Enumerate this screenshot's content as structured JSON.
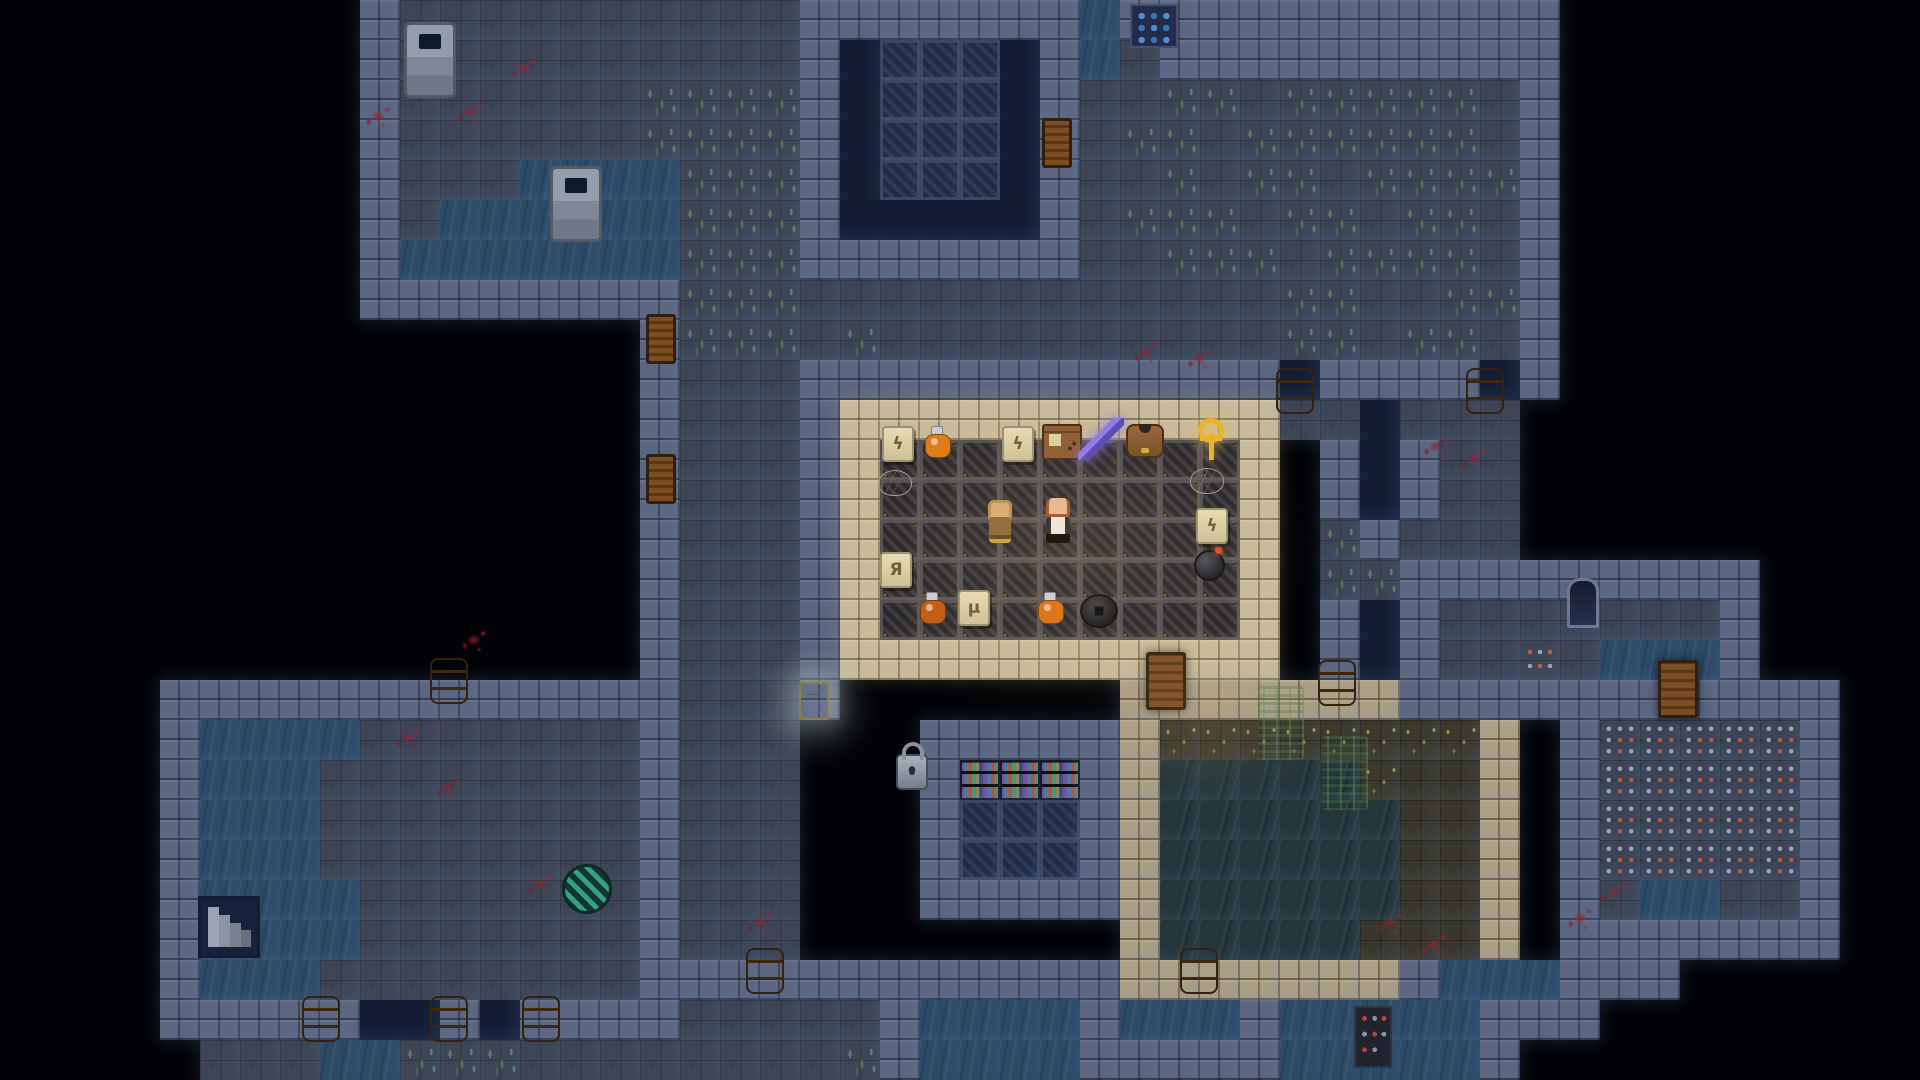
{
  "meta": {
    "game": "pixel-dungeon-roguelike",
    "scene": "sewer-depth-shop-level",
    "visible_text": [],
    "accent_colors": {
      "torch_warm": "#ffd28a",
      "glow_cool": "#7396cd",
      "blood": "#8e2030",
      "gold": "#e8b42a"
    }
  },
  "map": {
    "tile_size": 40,
    "cols": 48,
    "rows": 27,
    "legend": {
      "#": {
        "css": "tile-wall",
        "name": "wall",
        "interactable": false
      },
      ".": {
        "css": "tile-floor",
        "name": "floor",
        "interactable": true
      },
      ",": {
        "css": "tile-grass",
        "name": "floor-grass",
        "interactable": true
      },
      "~": {
        "css": "tile-water",
        "name": "water",
        "interactable": true
      },
      "o": {
        "css": "tile-void",
        "name": "chasm",
        "interactable": false
      },
      "L": {
        "css": "tile-lattice",
        "name": "vault-lattice",
        "interactable": false
      },
      "l": {
        "css": "tile-shoplattice",
        "name": "shop-floor",
        "interactable": true
      },
      "S": {
        "css": "tile-shopwall",
        "name": "shop-wall",
        "interactable": false
      },
      "C": {
        "css": "tile-cavewall",
        "name": "cave-wall",
        "interactable": false
      },
      "c": {
        "css": "tile-cave",
        "name": "cave-floor",
        "interactable": true
      },
      "g": {
        "css": "tile-cavegrass",
        "name": "cave-grass",
        "interactable": true
      },
      "v": {
        "css": "tile-cavewater",
        "name": "cave-water",
        "interactable": true
      },
      "T": {
        "css": "tile-trap",
        "name": "trap-plate",
        "interactable": true
      },
      "r": {
        "css": "tile-dots",
        "name": "ember-tile",
        "interactable": true
      },
      "k": {
        "css": "tile-bookshelf",
        "name": "bookshelf",
        "interactable": true
      }
    },
    "rows_data": [
      "         #..........#######~###########         ",
      "         #..........#oLLLo#~.##########         ",
      "         #......,,,,#oLLLo#..,,.,,,,,.#         ",
      "         #......,,,,#oLLLo#.,,.,,,,,,.#         ",
      "         #...~~~~,,,#oLLLo#..,.,,.,,,,#         ",
      "         #.~~~~~~,,,#ooooo#.,,,.,,.,,.#         ",
      "         #~~~~~~~,,,#######..,,,.,,,,.#         ",
      "         ########,,,............,,..,,#         ",
      "                #,,,.,..........,,.,,.#         ",
      "                #...############o####o#         ",
      "                #...#SSSSSSSSSSS..o...          ",
      "                #...#SlllllllllS #o#..          ",
      "                #...#SlllllllllS #o#..          ",
      "                #...#SlllllllllS ,#...          ",
      "                #...#SlllllllllS ,,#########    ",
      "                #...#SlllllllllS #o#.......#    ",
      "                #...#SSSSSSSSSSS #o#..r.~~~#    ",
      "    #############...#       CCCCCCC###########  ",
      "    #~~~~.......#...   #####CggggggggC #TTTTT#  ",
      "    #~~~........#...   #kkk#CvvvvvgccC #TTTTT#  ",
      "    #~~~........#...   #LLL#CvvvvvvccC #TTTTT#  ",
      "    #~~~........#...   #LLL#CvvvvvvccC #TTTTT#  ",
      "    #~~~~.......#...   #####CvvvvvvccC #.~~..#  ",
      "    #~~~~.......#...        CvvvvvcccC #######  ",
      "    #~~~........############CCCCCCC#~~~###      ",
      "    #####oo#o####.....#~~~~#~~~#~~~~~###        ",
      "     ...~~,,,........,#~~~~#####~~~~~#          "
    ]
  },
  "sprites": [
    {
      "kind": "well",
      "name": "well",
      "x": 404,
      "y": 22
    },
    {
      "kind": "well",
      "name": "well",
      "x": 550,
      "y": 166
    },
    {
      "kind": "window",
      "name": "wall-grate-window",
      "x": 1130,
      "y": 4,
      "interactable": false
    },
    {
      "kind": "door-s",
      "name": "vault-room-door",
      "x": 1042,
      "y": 118
    },
    {
      "kind": "door-s",
      "name": "corridor-door",
      "x": 646,
      "y": 314
    },
    {
      "kind": "door-s",
      "name": "corridor-door",
      "x": 646,
      "y": 454
    },
    {
      "kind": "door",
      "name": "shop-cave-door",
      "x": 1146,
      "y": 652
    },
    {
      "kind": "door",
      "name": "trap-room-door",
      "x": 1658,
      "y": 660
    },
    {
      "kind": "barrel",
      "name": "barrel",
      "x": 430,
      "y": 658
    },
    {
      "kind": "barrel",
      "name": "barrel",
      "x": 1276,
      "y": 368
    },
    {
      "kind": "barrel",
      "name": "barrel",
      "x": 1466,
      "y": 368
    },
    {
      "kind": "barrel",
      "name": "barrel",
      "x": 1318,
      "y": 660
    },
    {
      "kind": "barrel",
      "name": "barrel",
      "x": 1180,
      "y": 948
    },
    {
      "kind": "barrel",
      "name": "barrel",
      "x": 302,
      "y": 996
    },
    {
      "kind": "barrel",
      "name": "barrel",
      "x": 430,
      "y": 996
    },
    {
      "kind": "barrel",
      "name": "barrel",
      "x": 522,
      "y": 996
    },
    {
      "kind": "barrel",
      "name": "barrel",
      "x": 746,
      "y": 948
    },
    {
      "kind": "lock",
      "name": "vault-padlock",
      "x": 896,
      "y": 744
    },
    {
      "kind": "sign",
      "name": "glowing-sign",
      "x": 799,
      "y": 682,
      "interactable": false
    },
    {
      "kind": "niche",
      "name": "wall-alcove",
      "x": 1567,
      "y": 578,
      "interactable": false
    },
    {
      "kind": "stairs",
      "name": "sunken-stairs",
      "x": 198,
      "y": 896
    },
    {
      "kind": "disc",
      "name": "striped-trap-disc",
      "x": 562,
      "y": 864
    },
    {
      "kind": "redstrip",
      "name": "studded-plate",
      "x": 1354,
      "y": 1006,
      "interactable": false
    },
    {
      "kind": "vine",
      "name": "hanging-vines",
      "x": 1258,
      "y": 686,
      "interactable": false
    },
    {
      "kind": "vine",
      "name": "hanging-vines",
      "x": 1322,
      "y": 736,
      "interactable": false
    },
    {
      "kind": "blood",
      "name": "blood-splatter",
      "x": 360,
      "y": 100,
      "interactable": false
    },
    {
      "kind": "blood",
      "name": "blood-splatter",
      "x": 452,
      "y": 96,
      "interactable": false
    },
    {
      "kind": "blood",
      "name": "blood-splatter",
      "x": 506,
      "y": 52,
      "interactable": false
    },
    {
      "kind": "blood",
      "name": "blood-splatter",
      "x": 1128,
      "y": 336,
      "interactable": false
    },
    {
      "kind": "blood",
      "name": "blood-splatter",
      "x": 1182,
      "y": 342,
      "interactable": false
    },
    {
      "kind": "blood",
      "name": "blood-splatter",
      "x": 1418,
      "y": 430,
      "interactable": false
    },
    {
      "kind": "blood",
      "name": "blood-splatter",
      "x": 1456,
      "y": 442,
      "interactable": false
    },
    {
      "kind": "blood",
      "name": "blood-splatter",
      "x": 390,
      "y": 722,
      "interactable": false
    },
    {
      "kind": "blood",
      "name": "blood-splatter",
      "x": 430,
      "y": 772,
      "interactable": false
    },
    {
      "kind": "blood",
      "name": "blood-splatter",
      "x": 522,
      "y": 868,
      "interactable": false
    },
    {
      "kind": "blood",
      "name": "blood-splatter",
      "x": 742,
      "y": 906,
      "interactable": false
    },
    {
      "kind": "blood",
      "name": "blood-splatter",
      "x": 456,
      "y": 624,
      "interactable": false
    },
    {
      "kind": "blood",
      "name": "blood-splatter",
      "x": 1372,
      "y": 906,
      "interactable": false
    },
    {
      "kind": "blood",
      "name": "blood-splatter",
      "x": 1562,
      "y": 902,
      "interactable": false
    },
    {
      "kind": "blood",
      "name": "blood-splatter",
      "x": 1416,
      "y": 928,
      "interactable": false
    },
    {
      "kind": "blood",
      "name": "blood-splatter",
      "x": 1596,
      "y": 876,
      "interactable": false
    }
  ],
  "shop": {
    "items": [
      {
        "kind": "scroll",
        "name": "scroll",
        "x": 882,
        "y": 426,
        "glyph": "ϟ"
      },
      {
        "kind": "potion",
        "name": "orange-potion",
        "x": 925,
        "y": 426,
        "color": "#e07818"
      },
      {
        "kind": "stick dart",
        "name": "throwing-dart",
        "x": 960,
        "y": 424
      },
      {
        "kind": "scroll",
        "name": "scroll",
        "x": 1002,
        "y": 426,
        "glyph": "ϟ"
      },
      {
        "kind": "box",
        "name": "wooden-chest",
        "x": 1042,
        "y": 424
      },
      {
        "kind": "sword",
        "name": "enchanted-blade",
        "x": 1078,
        "y": 418
      },
      {
        "kind": "armor",
        "name": "leather-armor",
        "x": 1126,
        "y": 424
      },
      {
        "kind": "ankh",
        "name": "golden-ankh",
        "x": 1196,
        "y": 418
      },
      {
        "kind": "pasty",
        "name": "pasty",
        "x": 878,
        "y": 470
      },
      {
        "kind": "pasty",
        "name": "pasty",
        "x": 1190,
        "y": 468
      },
      {
        "kind": "stick spear",
        "name": "spear",
        "x": 872,
        "y": 508
      },
      {
        "kind": "scroll",
        "name": "scroll",
        "x": 1196,
        "y": 508,
        "glyph": "ϟ"
      },
      {
        "kind": "scroll",
        "name": "scroll",
        "x": 880,
        "y": 552,
        "glyph": "Я"
      },
      {
        "kind": "bomb",
        "name": "bomb",
        "x": 1194,
        "y": 550
      },
      {
        "kind": "stick arrow",
        "name": "arrow",
        "x": 872,
        "y": 590
      },
      {
        "kind": "potion",
        "name": "amber-potion",
        "x": 920,
        "y": 592,
        "color": "#c05a10"
      },
      {
        "kind": "scroll",
        "name": "scroll",
        "x": 958,
        "y": 590,
        "glyph": "μ"
      },
      {
        "kind": "stick wand",
        "name": "gem-wand",
        "x": 994,
        "y": 588
      },
      {
        "kind": "potion",
        "name": "orange-potion",
        "x": 1038,
        "y": 592,
        "color": "#d96f12"
      },
      {
        "kind": "mine",
        "name": "mine-disc",
        "x": 1080,
        "y": 594
      }
    ],
    "characters": [
      {
        "kind": "hero",
        "name": "hooded-adventurer",
        "x": 982,
        "y": 500
      },
      {
        "kind": "keeper",
        "name": "shopkeeper",
        "x": 1040,
        "y": 498
      }
    ]
  },
  "lights": [
    {
      "x": 816,
      "y": 372,
      "w": 500,
      "h": 350,
      "c": "255,205,135",
      "a": 0.13
    },
    {
      "x": 1084,
      "y": 620,
      "w": 240,
      "h": 190,
      "c": "255,200,125",
      "a": 0.1
    },
    {
      "x": 760,
      "y": 648,
      "w": 120,
      "h": 120,
      "c": "215,235,255",
      "a": 0.12
    }
  ]
}
